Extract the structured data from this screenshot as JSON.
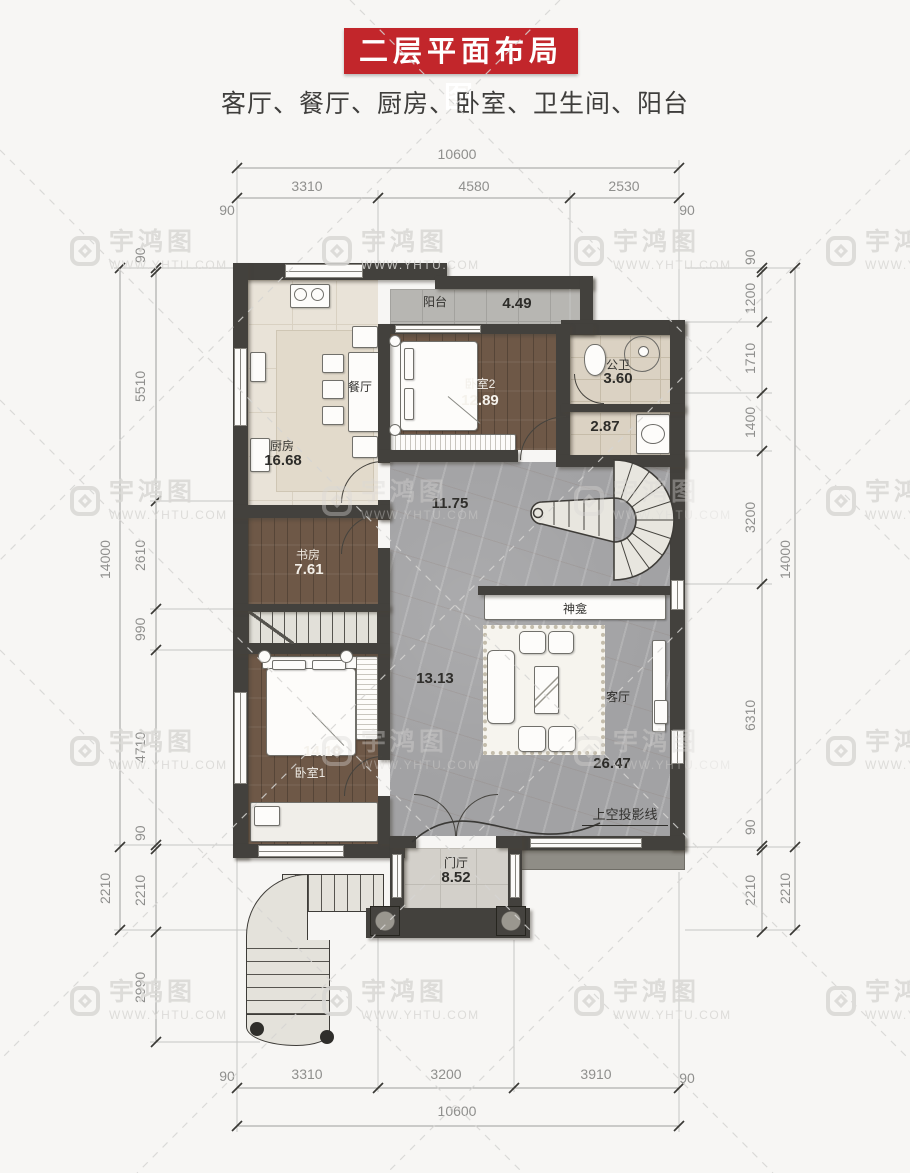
{
  "title": "二层平面布局图",
  "subtitle": "客厅、餐厅、厨房、卧室、卫生间、阳台",
  "watermark": {
    "brand": "宇鸿图",
    "url": "WWW.YHTU.COM"
  },
  "dimensions": {
    "top": {
      "total": "10600",
      "segments": [
        "3310",
        "4580",
        "2530"
      ],
      "left_edge": "90",
      "right_edge": "90"
    },
    "bottom": {
      "total": "10600",
      "segments": [
        "3310",
        "3200",
        "3910"
      ],
      "left_edge": "90",
      "right_edge": "90"
    },
    "left": {
      "total": "14000",
      "outer_bottom": "2210",
      "segments": [
        "90",
        "5510",
        "2610",
        "990",
        "4710",
        "90",
        "2210",
        "2990"
      ]
    },
    "right": {
      "total": "14000",
      "outer_bottom": "2210",
      "segments": [
        "90",
        "1200",
        "1710",
        "1400",
        "3200",
        "6310",
        "90",
        "2210"
      ]
    }
  },
  "rooms": {
    "balcony": {
      "label": "阳台",
      "area": "4.49"
    },
    "bedroom2": {
      "label": "卧室2",
      "area": "12.89"
    },
    "bathroom": {
      "label": "公卫",
      "area": "3.60"
    },
    "washroom": {
      "area": "2.87"
    },
    "dining": {
      "label": "餐厅"
    },
    "kitchen": {
      "label": "厨房",
      "area": "16.68"
    },
    "hall": {
      "area": "11.75"
    },
    "study": {
      "label": "书房",
      "area": "7.61"
    },
    "corridor": {
      "area": "13.13"
    },
    "bedroom1": {
      "label": "卧室1",
      "area": "14.18"
    },
    "living": {
      "label": "客厅",
      "area": "26.47"
    },
    "foyer": {
      "label": "门厅",
      "area": "8.52"
    }
  },
  "annotations": {
    "shrine": "神龛",
    "void_projection": "上空投影线"
  },
  "colors": {
    "banner_red": "#c2262b",
    "wall_dark": "#43413d",
    "wood": "#6e5847",
    "marble": "#a2a2a4"
  }
}
